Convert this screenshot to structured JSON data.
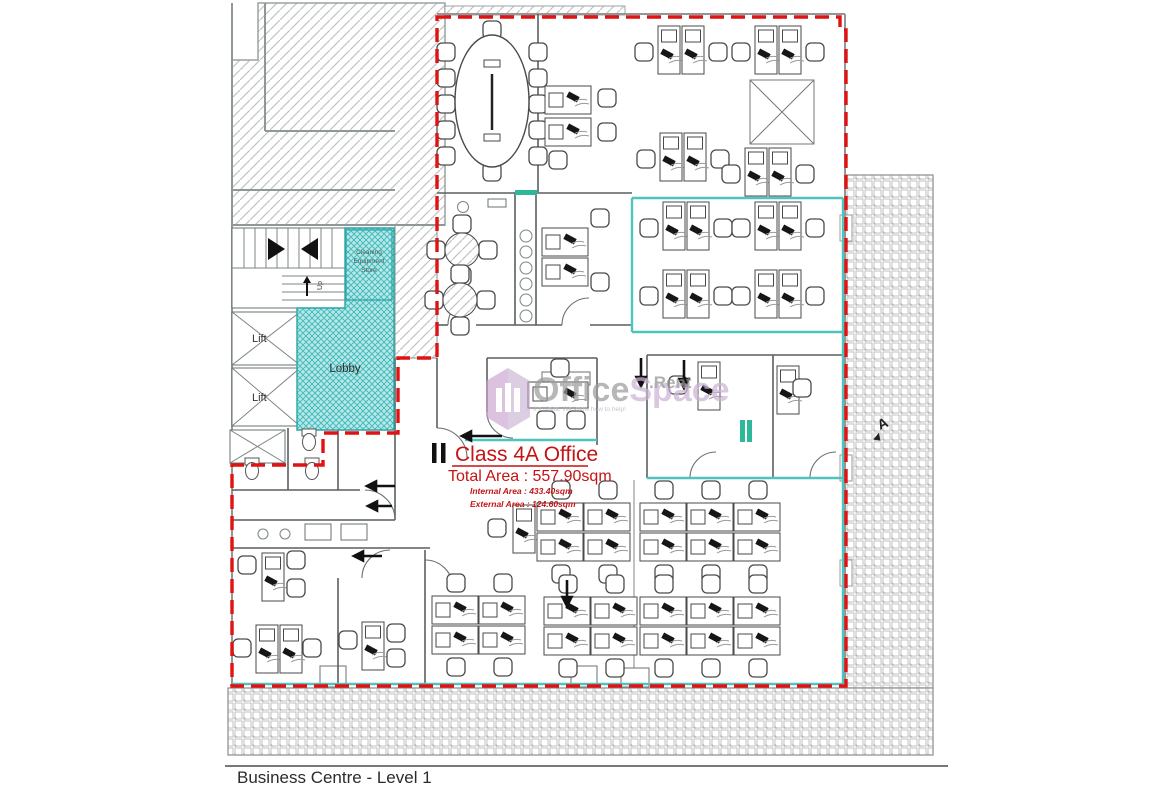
{
  "plan": {
    "title": "Business Centre - Level 1",
    "office": {
      "name": "Class 4A Office",
      "total_area": "Total Area : 557.90sqm",
      "internal_area": "Internal Area : 433.40sqm",
      "external_area": "External Area : 124.60sqm"
    },
    "rooms": {
      "lobby": "Lobby",
      "lift_upper": "Lift",
      "lift_lower": "Lift",
      "store": [
        "Cleaning",
        "Equipment",
        "Store"
      ],
      "stair_up": "Up"
    },
    "section_marker": "A",
    "colors": {
      "demise_red": "#e01212",
      "label_red": "#c41414",
      "partition_teal": "#4fc3bd",
      "lobby_fill": "#8edcdc",
      "wall_gray": "#8f9797",
      "furniture_line": "#4a4a4a"
    }
  },
  "watermark": {
    "brand_primary": "Office",
    "brand_secondary": "Space",
    "brand_suffix": ".Rent",
    "tagline": "It's Malta. We know how to help!"
  }
}
